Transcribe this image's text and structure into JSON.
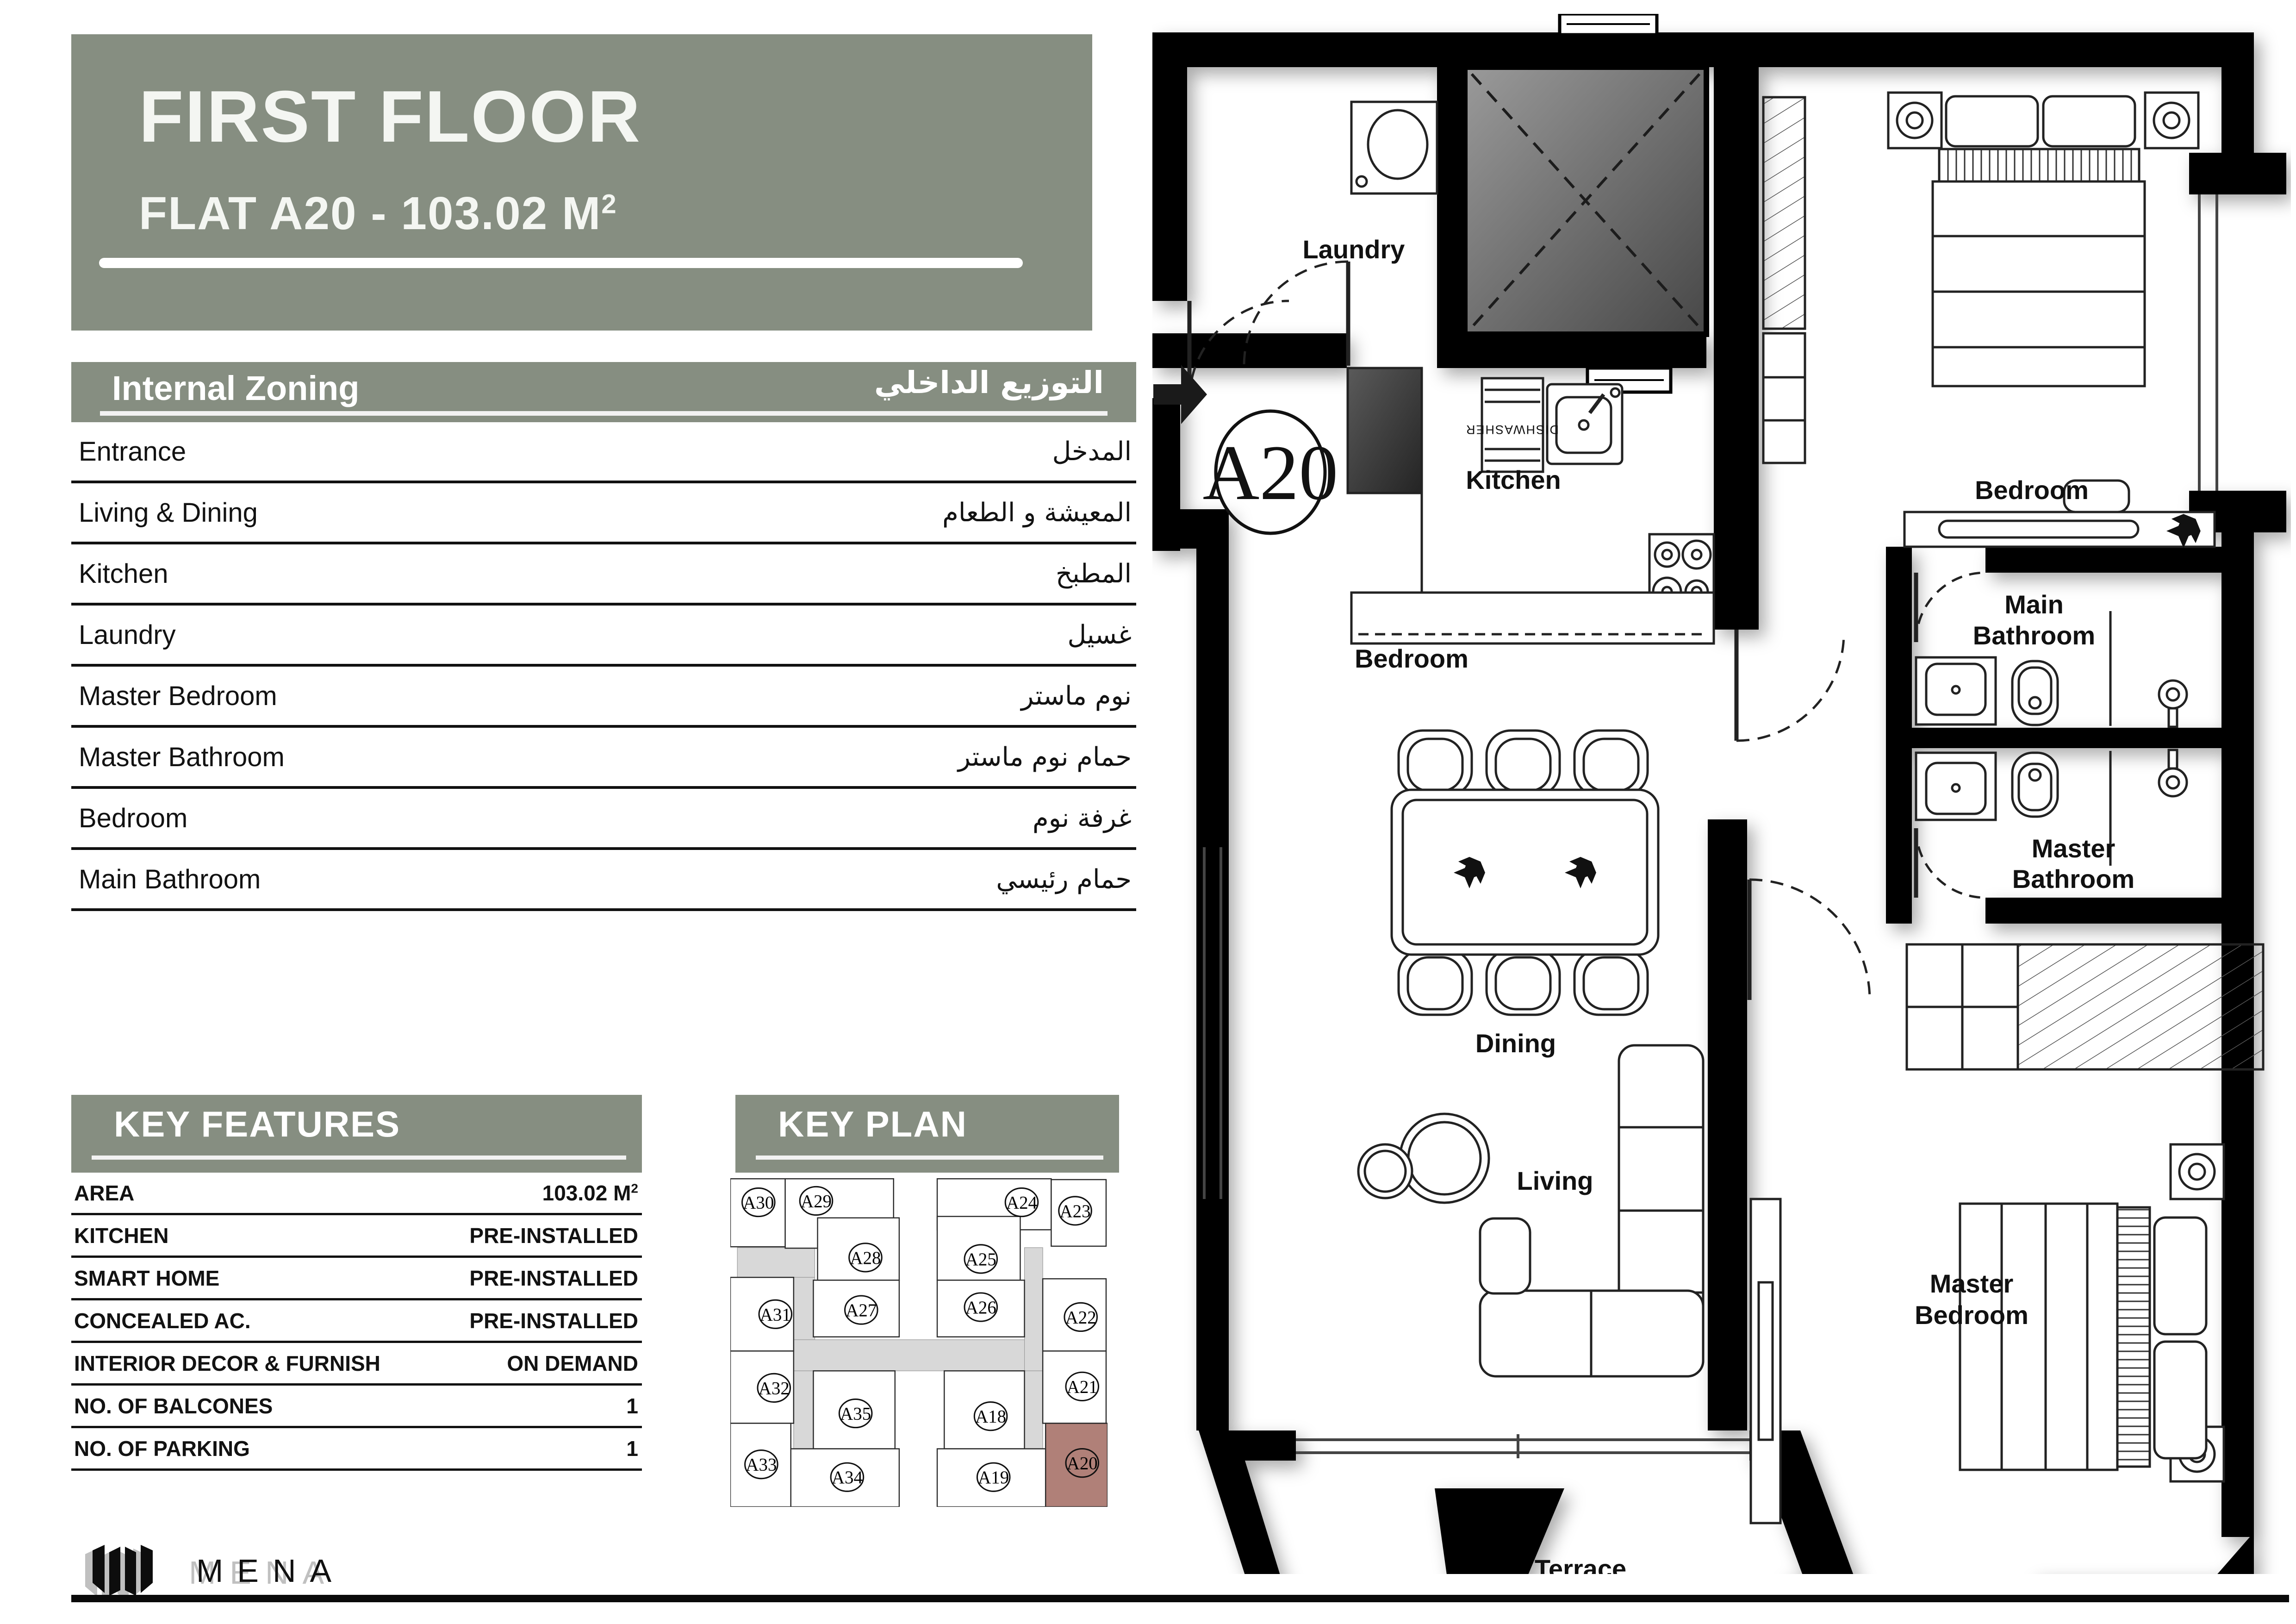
{
  "header": {
    "title": "FIRST FLOOR",
    "subtitle": "FLAT A20 - 103.02 M",
    "superscript": "2"
  },
  "internal_zoning": {
    "title_en": "Internal Zoning",
    "title_ar": "التوزيع الداخلي",
    "rows": [
      {
        "en": "Entrance",
        "ar": "المدخل"
      },
      {
        "en": "Living & Dining",
        "ar": "المعيشة و الطعام"
      },
      {
        "en": "Kitchen",
        "ar": "المطبخ"
      },
      {
        "en": "Laundry",
        "ar": "غسيل"
      },
      {
        "en": "Master Bedroom",
        "ar": "نوم ماستر"
      },
      {
        "en": "Master Bathroom",
        "ar": "حمام نوم ماستر"
      },
      {
        "en": "Bedroom",
        "ar": "غرفة نوم"
      },
      {
        "en": "Main Bathroom",
        "ar": "حمام رئيسي"
      }
    ]
  },
  "key_features": {
    "title": "KEY FEATURES",
    "rows": [
      {
        "label": "AREA",
        "value": "103.02 M",
        "sup": "2"
      },
      {
        "label": "KITCHEN",
        "value": "PRE-INSTALLED",
        "sup": ""
      },
      {
        "label": "SMART HOME",
        "value": "PRE-INSTALLED",
        "sup": ""
      },
      {
        "label": "CONCEALED AC.",
        "value": "PRE-INSTALLED",
        "sup": ""
      },
      {
        "label": "INTERIOR DECOR & FURNISH",
        "value": "ON DEMAND",
        "sup": ""
      },
      {
        "label": "NO. OF BALCONES",
        "value": "1",
        "sup": ""
      },
      {
        "label": "NO. OF PARKING",
        "value": "1",
        "sup": ""
      }
    ]
  },
  "key_plan": {
    "title": "KEY PLAN",
    "highlighted_unit": "A20",
    "units": [
      "A30",
      "A29",
      "A24",
      "A23",
      "A28",
      "A25",
      "A31",
      "A27",
      "A26",
      "A22",
      "A32",
      "A35",
      "A18",
      "A21",
      "A33",
      "A34",
      "A19",
      "A20"
    ]
  },
  "floor_plan": {
    "unit_label": "A20",
    "dishwasher": "DISHWASHER",
    "labels": {
      "laundry": "Laundry",
      "kitchen": "Kitchen",
      "bedroom_top": "Bedroom",
      "bedroom_mid": "Bedroom",
      "dining": "Dining",
      "living": "Living",
      "terrace": "Terrace",
      "main_bath_1": "Main",
      "main_bath_2": "Bathroom",
      "master_bath_1": "Master",
      "master_bath_2": "Bathroom",
      "master_bed_1": "Master",
      "master_bed_2": "Bedroom"
    }
  },
  "logo": {
    "text": "MENA"
  },
  "colors": {
    "accent_green": "#868e81",
    "highlight_rose": "#b08078",
    "corridor_gray": "#d8d8d8",
    "wall_black": "#000000"
  }
}
